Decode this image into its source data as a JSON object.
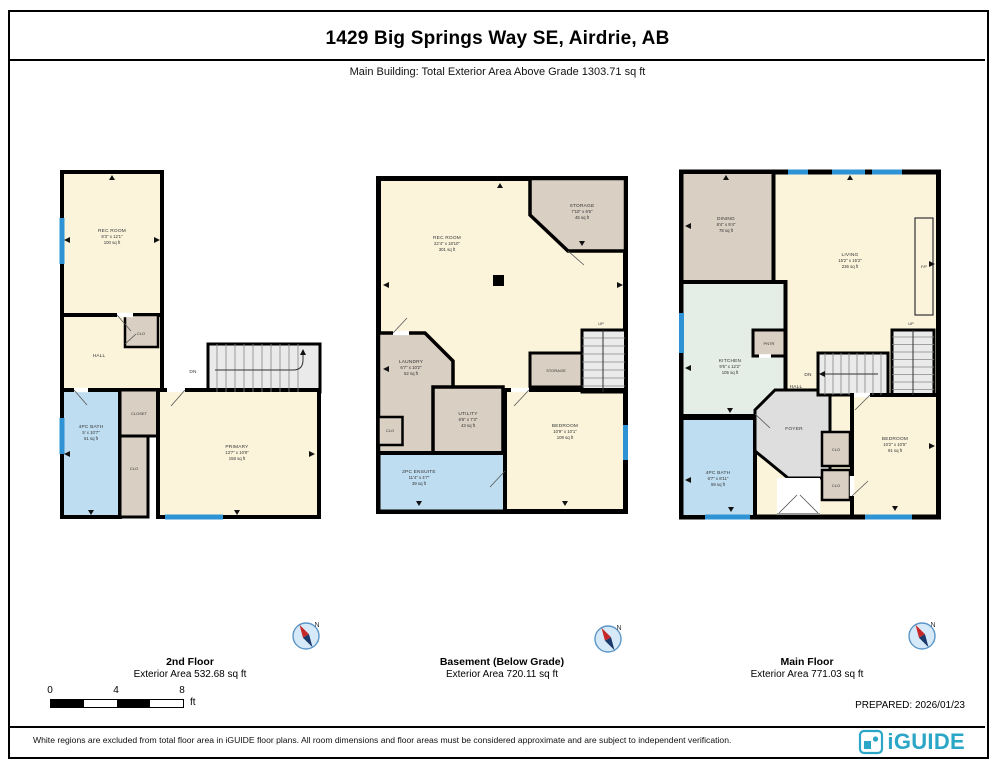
{
  "header": {
    "title": "1429 Big Springs Way SE, Airdrie, AB",
    "subtitle": "Main Building: Total Exterior Area Above Grade 1303.71 sq ft"
  },
  "plans": {
    "second": {
      "label": "2nd Floor",
      "area": "Exterior Area 532.68 sq ft",
      "rooms": {
        "rec_room": {
          "name": "REC ROOM",
          "dims": "8'3\" x 12'1\"",
          "area": "100 sq ft"
        },
        "hall": {
          "name": "HALL"
        },
        "clo_top": {
          "name": "CLO"
        },
        "stairs": {
          "name": "DN"
        },
        "closet": {
          "name": "CLOSET"
        },
        "bath": {
          "name": "4PC BATH",
          "dims": "5' x 10'7\"",
          "area": "51 sq ft"
        },
        "clo": {
          "name": "CLO"
        },
        "primary": {
          "name": "PRIMARY",
          "dims": "13'7\" x 10'9\"",
          "area": "158 sq ft"
        }
      }
    },
    "basement": {
      "label": "Basement (Below Grade)",
      "area": "Exterior Area 720.11 sq ft",
      "rooms": {
        "rec_room": {
          "name": "REC ROOM",
          "dims": "22'4\" x 18'10\"",
          "area": "301 sq ft"
        },
        "storage": {
          "name": "STORAGE",
          "dims": "7'10\" x 6'6\"",
          "area": "45 sq ft"
        },
        "up": {
          "name": "UP"
        },
        "storage2": {
          "name": "STORAGE"
        },
        "laundry": {
          "name": "LAUNDRY",
          "dims": "6'7\" x 10'2\"",
          "area": "52 sq ft"
        },
        "clo": {
          "name": "CLO"
        },
        "utility": {
          "name": "UTILITY",
          "dims": "6'6\" x 7'3\"",
          "area": "43 sq ft"
        },
        "ensuite": {
          "name": "2PC ENSUITE",
          "dims": "11'4\" x 4'7\"",
          "area": "39 sq ft"
        },
        "bedroom": {
          "name": "BEDROOM",
          "dims": "10'9\" x 10'1\"",
          "area": "109 sq ft"
        }
      }
    },
    "main": {
      "label": "Main Floor",
      "area": "Exterior Area 771.03 sq ft",
      "rooms": {
        "dining": {
          "name": "DINING",
          "dims": "8'4\" x 9'4\"",
          "area": "78 sq ft"
        },
        "living": {
          "name": "LIVING",
          "dims": "15'2\" x 15'2\"",
          "area": "236 sq ft"
        },
        "fp": {
          "name": "F/P"
        },
        "pntr": {
          "name": "PNTR"
        },
        "kitchen": {
          "name": "KITCHEN",
          "dims": "9'6\" x 12'2\"",
          "area": "105 sq ft"
        },
        "hall": {
          "name": "HALL"
        },
        "dn": {
          "name": "DN"
        },
        "up": {
          "name": "UP"
        },
        "foyer": {
          "name": "FOYER"
        },
        "clo1": {
          "name": "CLO"
        },
        "clo2": {
          "name": "CLO"
        },
        "bedroom": {
          "name": "BEDROOM",
          "dims": "10'2\" x 10'5\"",
          "area": "91 sq ft"
        },
        "bath": {
          "name": "4PC BATH",
          "dims": "6'7\" x 8'11\"",
          "area": "59 sq ft"
        }
      }
    }
  },
  "compass": {
    "north": "N"
  },
  "scale": {
    "ticks": [
      "0",
      "4",
      "8"
    ],
    "unit": "ft"
  },
  "prepared": "PREPARED: 2026/01/23",
  "disclaimer": "White regions are excluded from total floor area in iGUIDE floor plans. All room dimensions and floor areas must be considered approximate and are subject to independent verification.",
  "brand": {
    "name": "iGUIDE"
  },
  "colors": {
    "floor": "#FBF4DB",
    "secondary": "#D9CFC2",
    "bath": "#BFDDF1",
    "kitchen": "#E4EEE6",
    "foyer": "#DEDEDE",
    "window": "#2E93D4",
    "wall": "#000000",
    "accent": "#2BA6C6"
  }
}
